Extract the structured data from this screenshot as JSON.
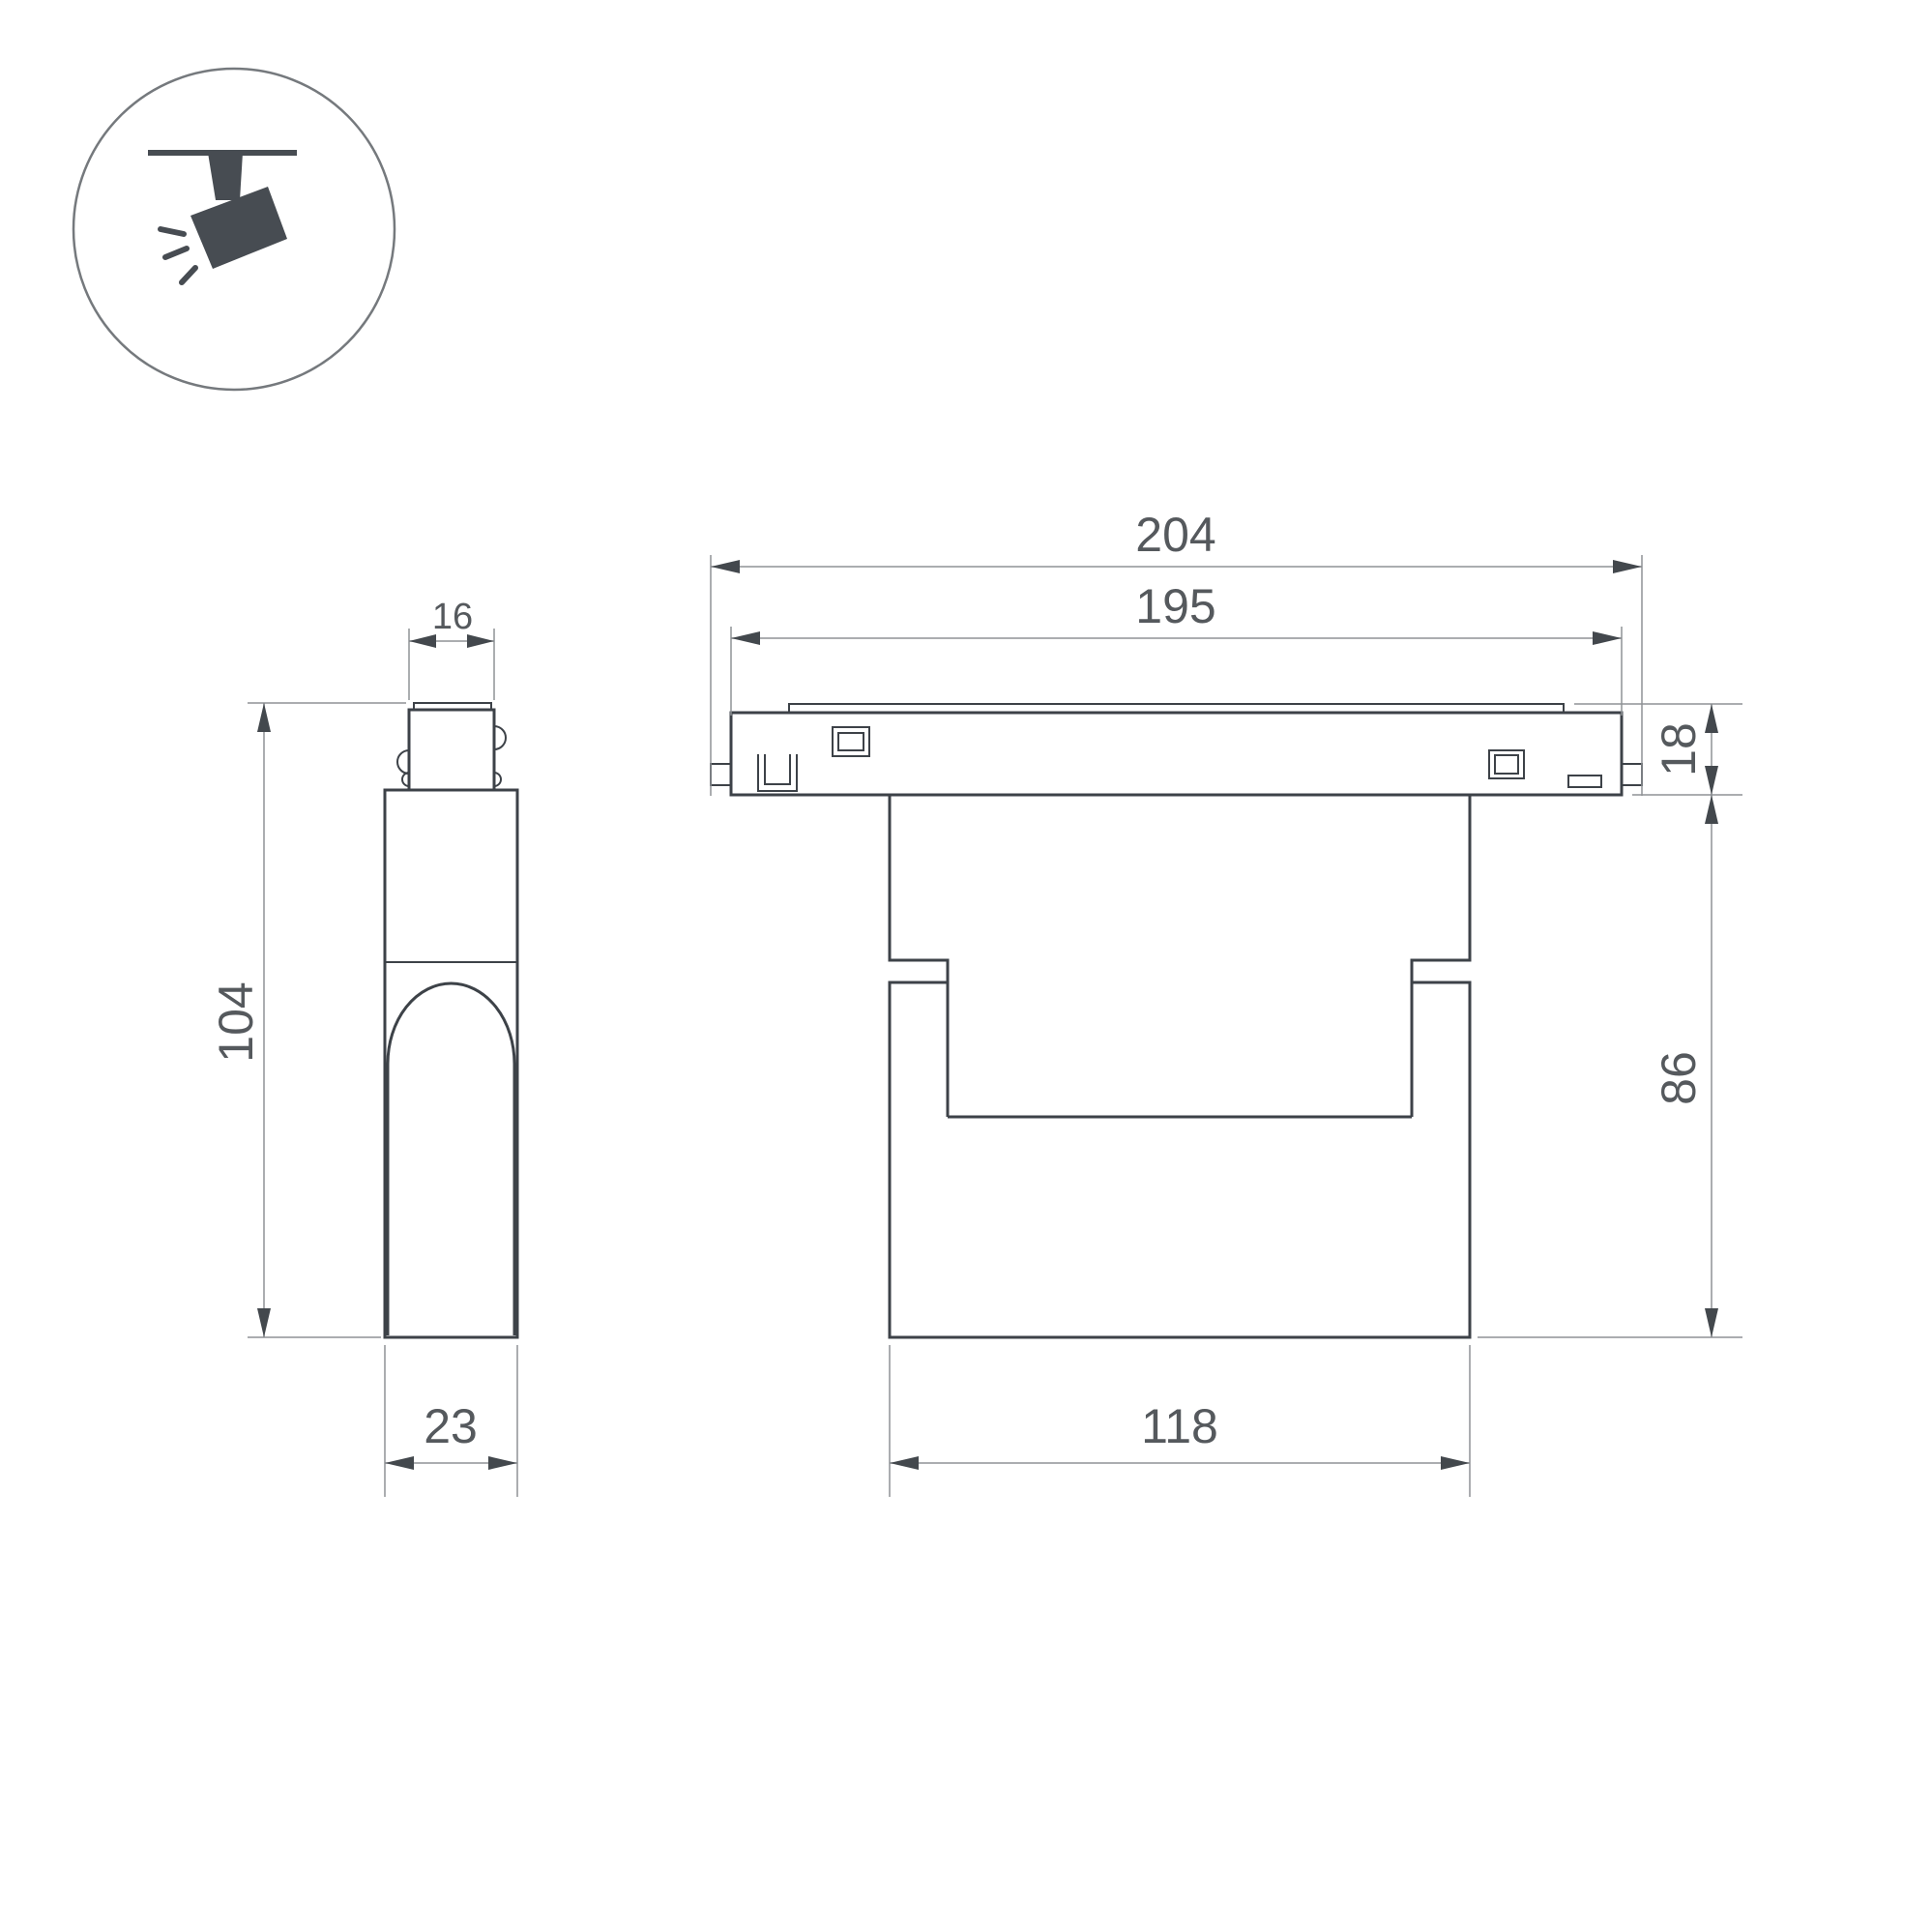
{
  "page": {
    "background": "#ffffff"
  },
  "icon": {
    "name": "ceiling-track-spotlight",
    "glyph_color": "#474c52",
    "circle_color": "#75797d"
  },
  "style": {
    "outline_color": "#3d4248",
    "dimension_line_color": "#8f9296",
    "dimension_text_color": "#55595d",
    "arrowhead_color": "#43484d"
  },
  "dims": {
    "track_overall_width": {
      "value": "204"
    },
    "track_length": {
      "value": "195"
    },
    "track_height": {
      "value": "18"
    },
    "body_height": {
      "value": "86"
    },
    "body_width": {
      "value": "118"
    },
    "total_height": {
      "value": "104"
    },
    "adapter_width": {
      "value": "16"
    },
    "body_depth": {
      "value": "23"
    }
  }
}
